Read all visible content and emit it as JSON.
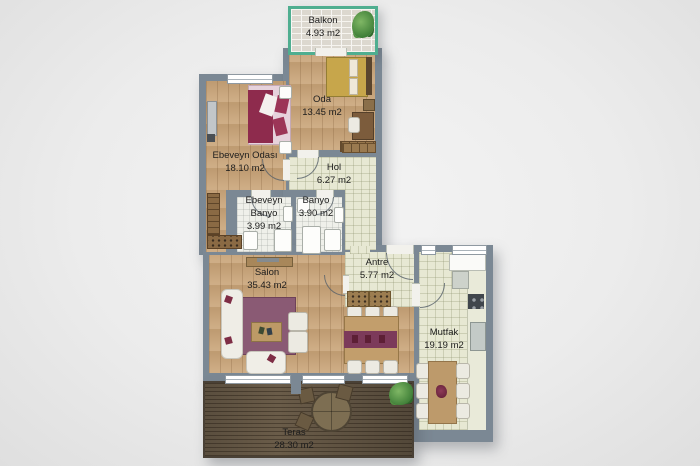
{
  "plan": {
    "title": "apartment-floor-plan",
    "rooms": {
      "balkon": {
        "name": "Balkon",
        "area": "4.93 m2"
      },
      "oda": {
        "name": "Oda",
        "area": "13.45 m2"
      },
      "ebeveyn_odasi": {
        "name": "Ebeveyn Odası",
        "area": "18.10 m2"
      },
      "hol": {
        "name": "Hol",
        "area": "6.27 m2"
      },
      "ebeveyn_banyo": {
        "name_line1": "Ebeveyn",
        "name_line2": "Banyo",
        "area": "3.99 m2"
      },
      "banyo": {
        "name": "Banyo",
        "area": "3.90 m2"
      },
      "salon": {
        "name": "Salon",
        "area": "35.43 m2"
      },
      "antre": {
        "name": "Antre",
        "area": "5.77 m2"
      },
      "mutfak": {
        "name": "Mutfak",
        "area": "19.19 m2"
      },
      "teras": {
        "name": "Teras",
        "area": "28.30 m2"
      }
    },
    "colors": {
      "wall": "#7b8894",
      "wood_floor": "#c9a478",
      "tile_floor": "#e7e8d3",
      "bath_floor": "#eff0ea",
      "deck_floor": "#6a5c49",
      "balcony_trim": "#4fae90",
      "rug_accent": "#8a5a74",
      "bed_accent": "#8e2b4d",
      "background": "#ececec"
    },
    "icons": {
      "balcony_plant": "plant-icon",
      "teras_plant": "plant-icon"
    }
  }
}
